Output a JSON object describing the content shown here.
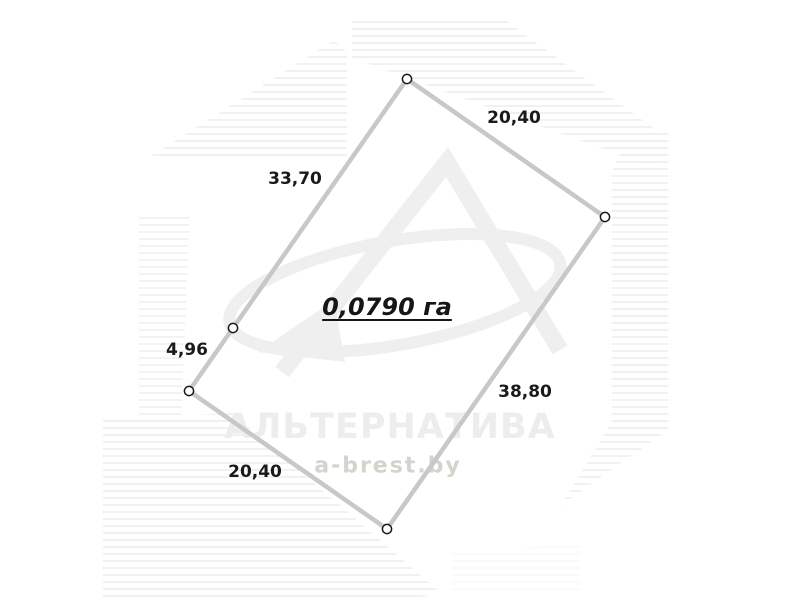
{
  "diagram": {
    "type": "land-plot-survey-plan",
    "area_label": {
      "text": "0,0790 га"
    },
    "vertices": [
      {
        "x": 407,
        "y": 79
      },
      {
        "x": 605,
        "y": 217
      },
      {
        "x": 387,
        "y": 529
      },
      {
        "x": 189,
        "y": 391
      },
      {
        "x": 233,
        "y": 328
      }
    ],
    "side_labels": [
      {
        "text": "20,40",
        "x": 514,
        "y": 118
      },
      {
        "text": "38,80",
        "x": 525,
        "y": 392
      },
      {
        "text": "20,40",
        "x": 255,
        "y": 472
      },
      {
        "text": "4,96",
        "x": 187,
        "y": 350
      },
      {
        "text": "33,70",
        "x": 295,
        "y": 179
      }
    ],
    "colors": {
      "boundary": "#c8c8c8",
      "marker_fill": "#ffffff",
      "marker_stroke": "#1a1a1a",
      "label_text": "#1a1a1a"
    }
  },
  "watermark": {
    "brand": "АЛЬТЕРНАТИВА",
    "site": "a-brest.by",
    "logo": "alternativa-a-swoosh-logo",
    "stripe_color": "#f0f0f0",
    "logo_color": "#efefef"
  }
}
